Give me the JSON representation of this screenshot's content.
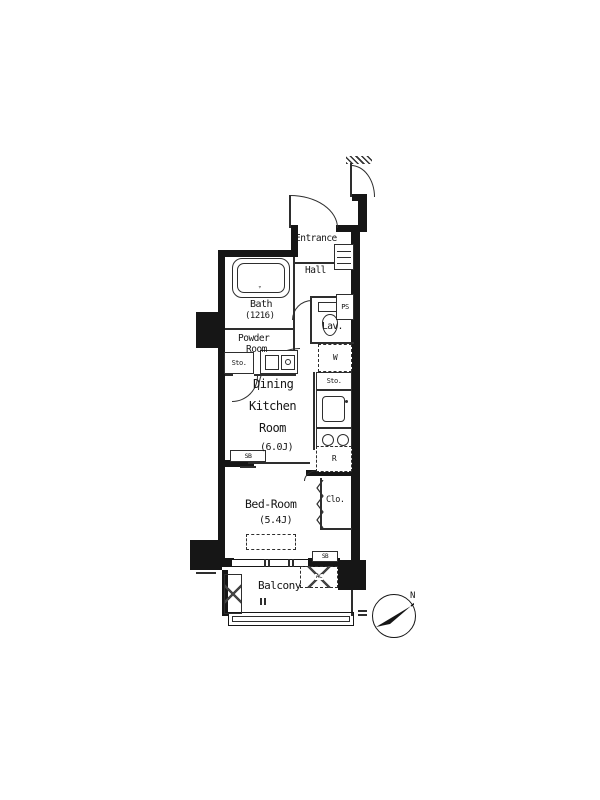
{
  "plan": {
    "rooms": {
      "entrance": "Entrance",
      "hall": "Hall",
      "bath": "Bath",
      "bath_size": "(1216)",
      "powder_1": "Powder",
      "powder_2": "Room",
      "lav": "Lav.",
      "dk_1": "Dining",
      "dk_2": "Kitchen",
      "dk_3": "Room",
      "dk_size": "(6.0J)",
      "bedroom": "Bed-Room",
      "bedroom_size": "(5.4J)",
      "closet": "Clo.",
      "balcony": "Balcony"
    },
    "fixtures": {
      "storage_left": "Sto.",
      "storage_right": "Sto.",
      "pipe_space": "PS",
      "washer": "W",
      "refrigerator": "R",
      "shutter_box_upper": "SB",
      "shutter_box_lower": "SB",
      "ac": "AC"
    },
    "compass": {
      "north": "N"
    }
  },
  "colors": {
    "wall": "#161616",
    "line": "#2e2e2e",
    "bg": "#ffffff"
  }
}
